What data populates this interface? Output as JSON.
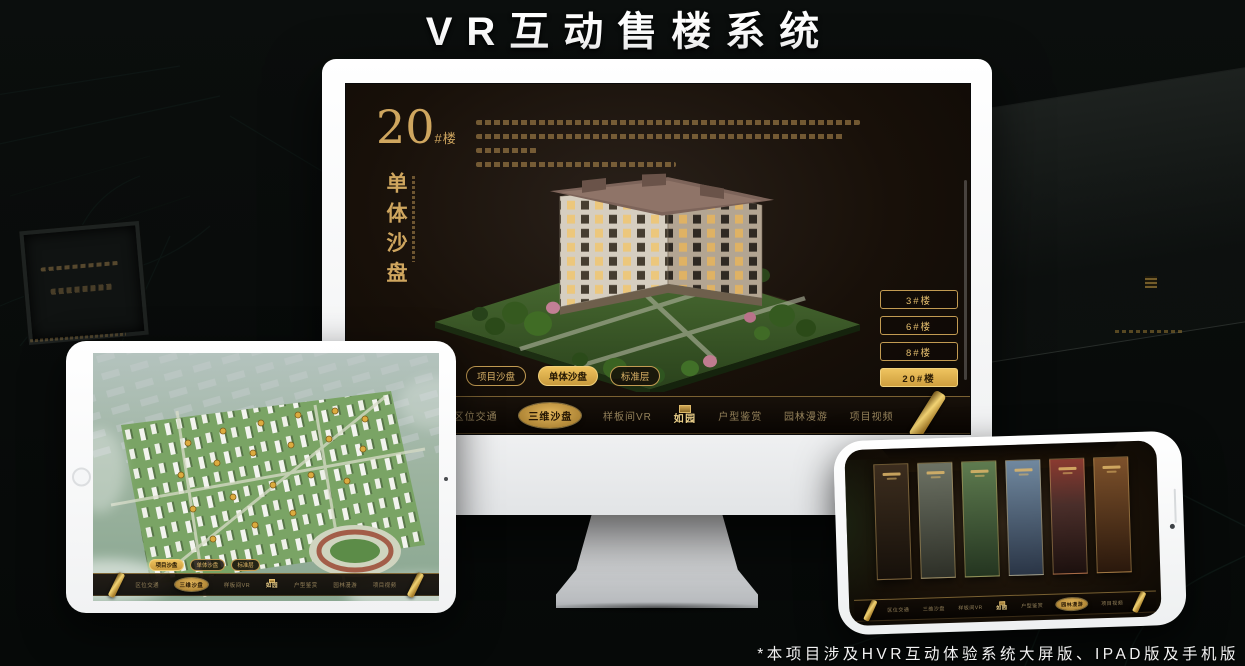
{
  "page": {
    "title": "VR互动售楼系统",
    "footnote": "*本项目涉及HVR互动体验系统大屏版、IPAD版及手机版"
  },
  "colors": {
    "accent_gold": "#d2a755",
    "screen_bg": "#1a130d"
  },
  "monitor": {
    "building_label": {
      "number": "20",
      "suffix": "#楼"
    },
    "mode_title": "单体沙盘",
    "floor_buttons": [
      {
        "label": "3#楼",
        "active": false
      },
      {
        "label": "6#楼",
        "active": false
      },
      {
        "label": "8#楼",
        "active": false
      },
      {
        "label": "20#楼",
        "active": true
      }
    ],
    "sub_tabs": [
      {
        "label": "项目沙盘",
        "active": false
      },
      {
        "label": "单体沙盘",
        "active": true
      },
      {
        "label": "标准层",
        "active": false
      }
    ],
    "nav": {
      "logo": "如园",
      "items": [
        {
          "label": "区位交通",
          "active": false
        },
        {
          "label": "三维沙盘",
          "active": true
        },
        {
          "label": "样板间VR",
          "active": false
        },
        {
          "label": "户型鉴赏",
          "active": false
        },
        {
          "label": "园林漫游",
          "active": false
        },
        {
          "label": "项目视频",
          "active": false
        }
      ]
    }
  },
  "tablet": {
    "sub_tabs": [
      {
        "label": "项目沙盘",
        "active": true
      },
      {
        "label": "单体沙盘",
        "active": false
      },
      {
        "label": "标准层",
        "active": false
      }
    ],
    "nav": {
      "logo": "如园",
      "items": [
        {
          "label": "区位交通",
          "active": false
        },
        {
          "label": "三维沙盘",
          "active": true
        },
        {
          "label": "样板间VR",
          "active": false
        },
        {
          "label": "户型鉴赏",
          "active": false
        },
        {
          "label": "园林漫游",
          "active": false
        },
        {
          "label": "项目视频",
          "active": false
        }
      ]
    }
  },
  "phone": {
    "nav": {
      "logo": "如园",
      "items": [
        {
          "label": "区位交通",
          "active": false
        },
        {
          "label": "三维沙盘",
          "active": false
        },
        {
          "label": "样板间VR",
          "active": false
        },
        {
          "label": "户型鉴赏",
          "active": false
        },
        {
          "label": "园林漫游",
          "active": true
        },
        {
          "label": "项目视频",
          "active": false
        }
      ]
    }
  }
}
